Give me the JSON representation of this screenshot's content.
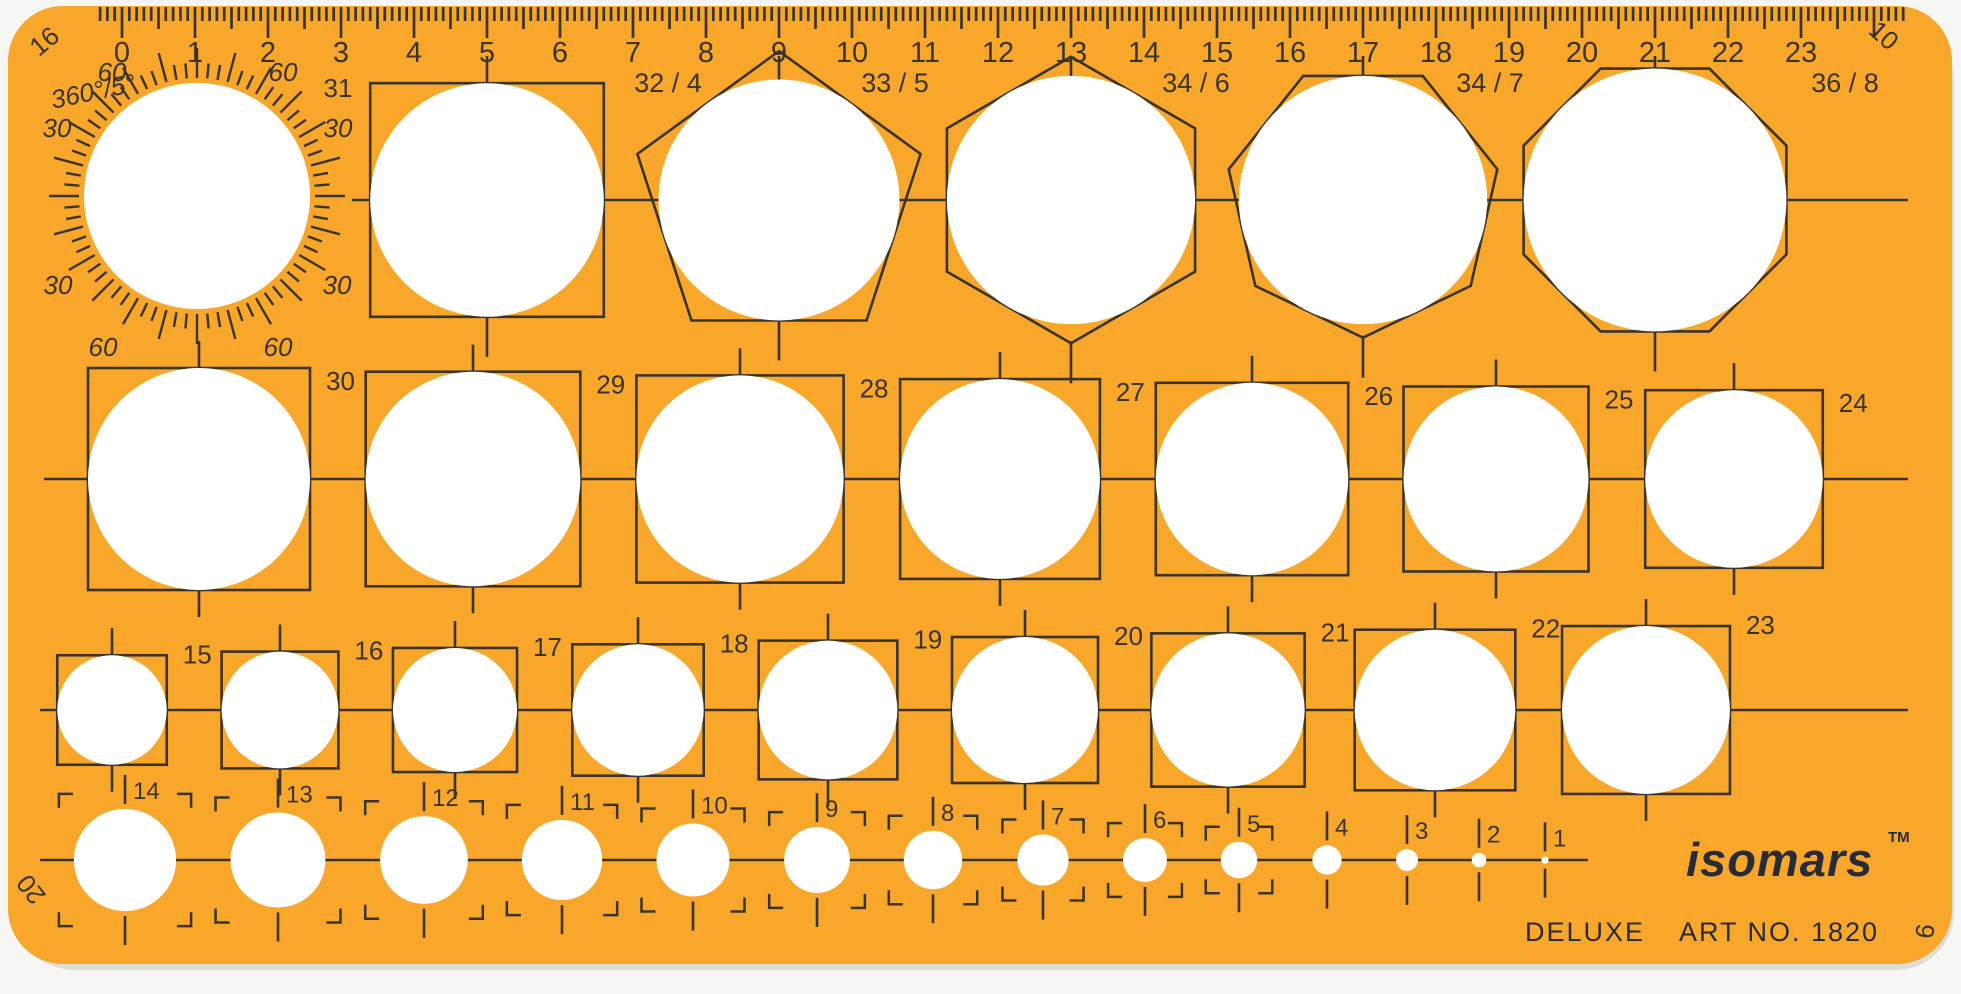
{
  "product": {
    "brand": "isomars",
    "trademark": "TM",
    "edition": "DELUXE",
    "art_no": "ART NO. 1820",
    "mold_numbers": {
      "top_left": "16",
      "top_right": "10",
      "bottom_left": "20",
      "bottom_right": "9"
    }
  },
  "colors": {
    "body": "#F8A72B",
    "engraving": "#3A3428",
    "brand_ink": "#272B33",
    "cutout": "#FFFFFF",
    "background": "#F6F6F4",
    "shadow": "#DEDED9"
  },
  "ruler": {
    "unit": "cm",
    "numbers": [
      "0",
      "1",
      "2",
      "3",
      "4",
      "5",
      "6",
      "7",
      "8",
      "9",
      "10",
      "11",
      "12",
      "13",
      "14",
      "15",
      "16",
      "17",
      "18",
      "19",
      "20",
      "21",
      "22",
      "23"
    ]
  },
  "protractor": {
    "title": "360°/5°",
    "circle_label": "31",
    "scale_labels": [
      "60",
      "60",
      "30",
      "30",
      "30",
      "30",
      "60",
      "60"
    ]
  },
  "shape_row": [
    {
      "label": "32 / 4",
      "sides": 4,
      "diameter_mm": 32
    },
    {
      "label": "33 / 5",
      "sides": 5,
      "diameter_mm": 33
    },
    {
      "label": "34 / 6",
      "sides": 6,
      "diameter_mm": 34
    },
    {
      "label": "34 / 7",
      "sides": 7,
      "diameter_mm": 34
    },
    {
      "label": "36 / 8",
      "sides": 8,
      "diameter_mm": 36
    }
  ],
  "circle_rows": {
    "large": {
      "labels": [
        "30",
        "29",
        "28",
        "27",
        "26",
        "25",
        "24"
      ],
      "diameters_mm": [
        30,
        29,
        28,
        27,
        26,
        25,
        24
      ]
    },
    "medium": {
      "labels": [
        "15",
        "16",
        "17",
        "18",
        "19",
        "20",
        "21",
        "22",
        "23"
      ],
      "diameters_mm": [
        15,
        16,
        17,
        18,
        19,
        20,
        21,
        22,
        23
      ]
    },
    "small": {
      "labels": [
        "14",
        "13",
        "12",
        "11",
        "10",
        "9",
        "8",
        "7",
        "6",
        "5",
        "4",
        "3",
        "2",
        "1"
      ],
      "diameters_mm": [
        14,
        13,
        12,
        11,
        10,
        9,
        8,
        7,
        6,
        5,
        4,
        3,
        2,
        1
      ]
    }
  }
}
